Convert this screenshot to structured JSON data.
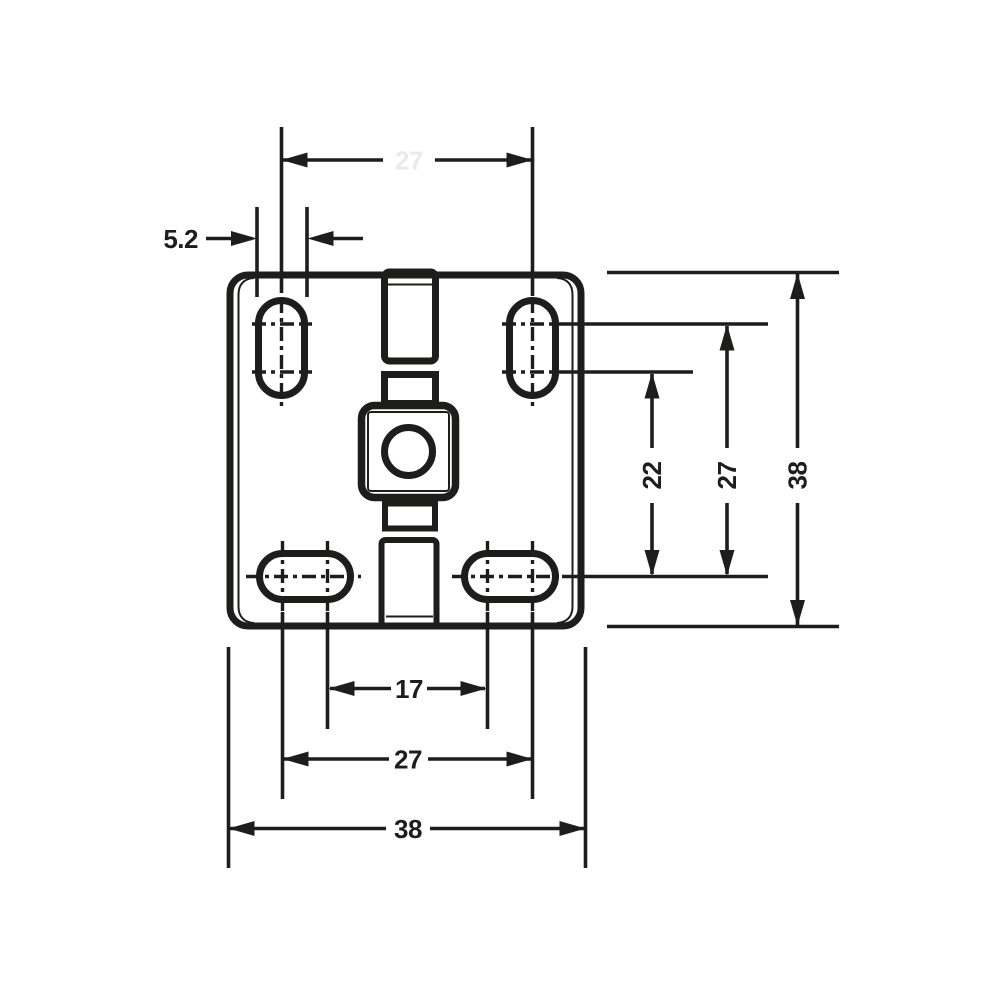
{
  "drawing": {
    "kind": "dimensioned technical drawing of a square mounting plate",
    "colors": {
      "line": "#1d1d1b",
      "ghost_label": "#e9e9ee",
      "background": "#ffffff"
    },
    "labels": {
      "top_slot_pitch": "27",
      "slot_width": "5.2",
      "right_pitch_inner": "22",
      "right_pitch_outer": "27",
      "right_overall": "38",
      "bottom_pitch_inner": "17",
      "bottom_pitch_outer": "27",
      "bottom_overall": "38"
    }
  }
}
